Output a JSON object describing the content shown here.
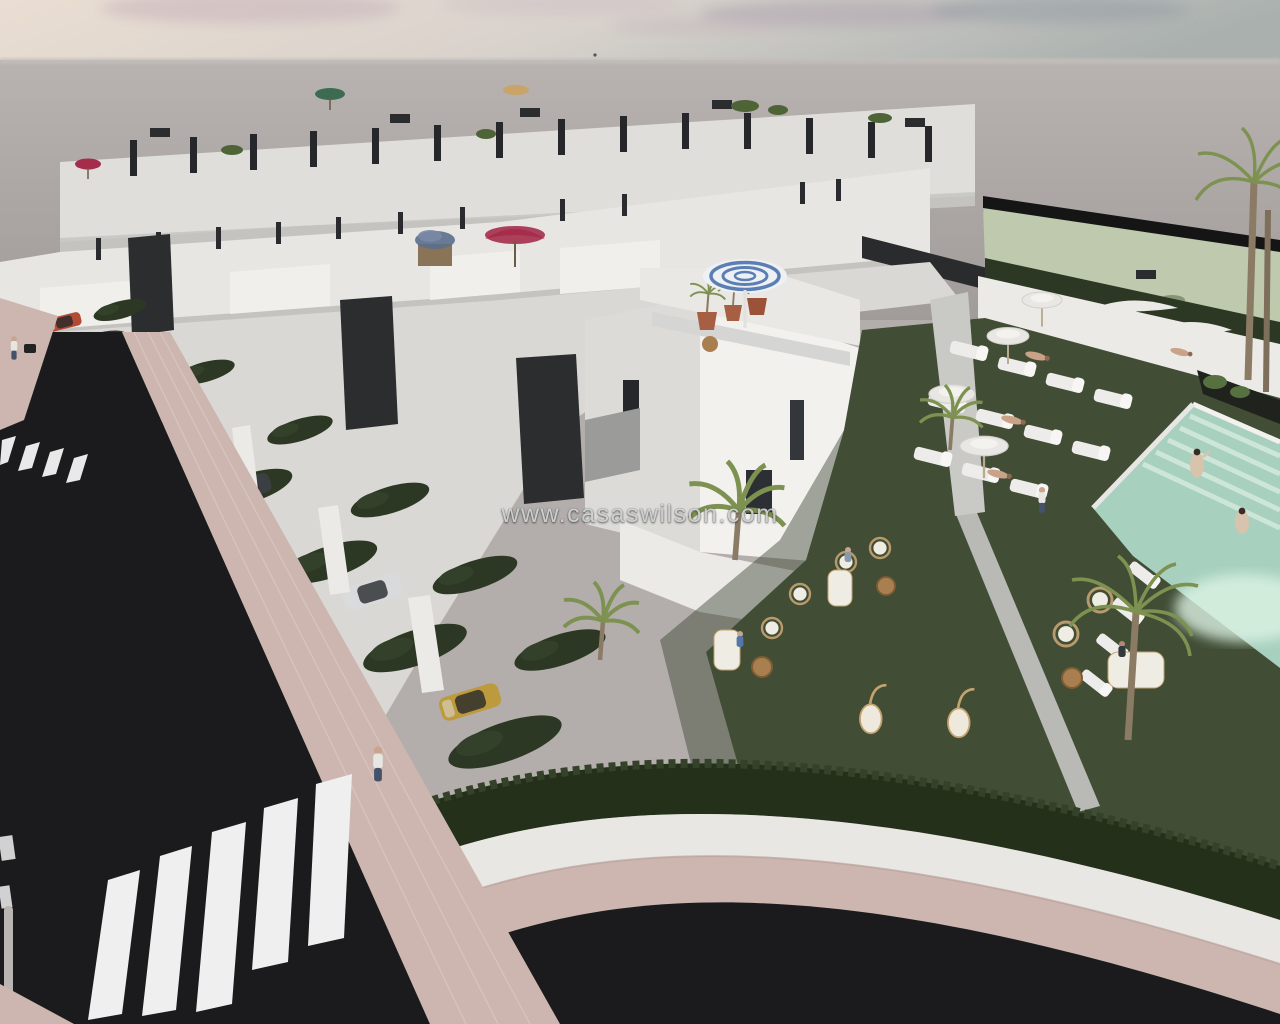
{
  "page": {
    "title": "New build residential development – 3D render"
  },
  "watermark": {
    "text": "www.casaswilson.com"
  },
  "scene": {
    "type": "3d-architectural-render",
    "elements": [
      "terraced-white-townhouses",
      "rooftop-terraces",
      "communal-pool",
      "sun-loungers",
      "parasols",
      "communal-lawn",
      "wicker-seating",
      "hanging-chairs",
      "palm-trees",
      "asphalt-road",
      "zebra-crossing",
      "pink-paved-sidewalk",
      "parked-cars",
      "pedestrians",
      "swimmers",
      "privacy-hedges",
      "sage-green-field",
      "hazy-pink-sky"
    ],
    "counts": {
      "swimmers": 2,
      "main_zebra_stripes": 5,
      "small_zebra_stripes": 4,
      "terrace_pots": 3
    },
    "colors": {
      "sky_left": "#e8dcd2",
      "sky_right": "#a9b0ae",
      "haze": "#b6b1af",
      "sea": "#a19c9a",
      "field": "#bec9ae",
      "field_edge": "#151515",
      "wall_lit": "#f2f1ee",
      "wall_mid": "#e3e2df",
      "wall_shade": "#cfcecb",
      "wall_dim": "#bfbfbd",
      "window": "#26272a",
      "panel_dark": "#2b2d2f",
      "louver_wood": "#8a6f52",
      "road": "#1b1b1d",
      "stripe": "#efefef",
      "sidewalk": "#ccb6af",
      "hedge": "#2c3823",
      "hedge_dark": "#243019",
      "lawn": "#414d35",
      "lawn_dark": "#394530",
      "pool_water": "#a7d0bf",
      "pool_steps": "#cfe7da",
      "pool_glow": "#ddf3e4",
      "deck": "#f0eeea",
      "umbrella_white": "#e9e7e3",
      "umbrella_red": "#a52c4a",
      "umbrella_blue": "#5b7fb4",
      "umbrella_green": "#3c6b52",
      "umbrella_tan": "#c9a368",
      "pot_terracotta": "#a65f43",
      "plant": "#567040",
      "palm_frond": "#7d9150",
      "palm_trunk": "#8b7b64",
      "wicker": "#b99a6d",
      "table_wood": "#a97f4f",
      "car_silver": "#b9bbbc",
      "car_yellow": "#bd9a3c",
      "car_dark": "#3c3f42",
      "car_red": "#b34a33",
      "car_white": "#e6e6e5",
      "skin": "#c9a287",
      "lamp_pole": "#b9b5b2"
    }
  }
}
